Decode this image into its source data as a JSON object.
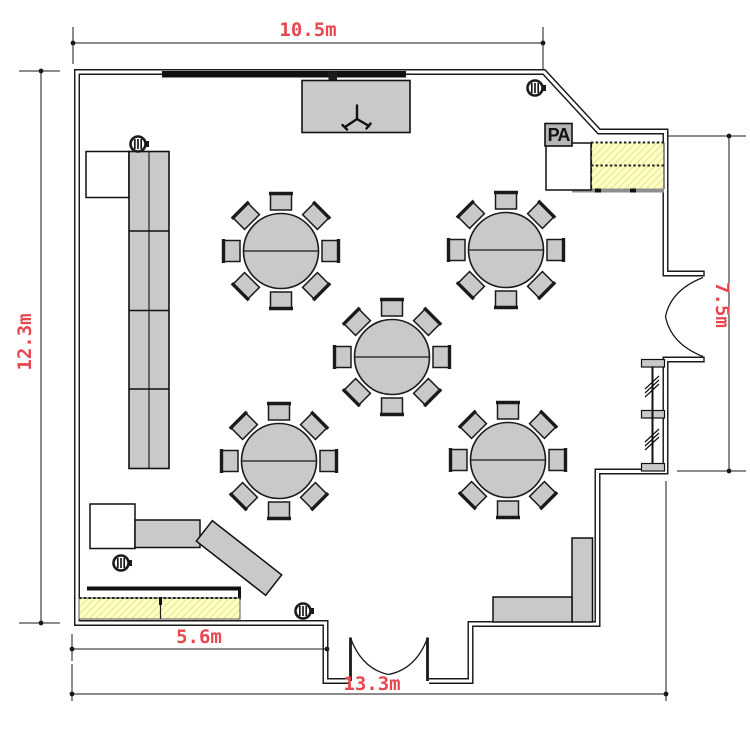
{
  "diagram": {
    "type": "floor-plan",
    "dims": {
      "top": "10.5m",
      "left": "12.3m",
      "right": "7.5m",
      "bottom_inner": "5.6m",
      "bottom_outer": "13.3m"
    },
    "labels": {
      "pa": "PA"
    },
    "colors": {
      "ink": "#1a1a1a",
      "dim_red": "#e8474f",
      "furniture_gray": "#c9c9c9",
      "hatch_fill": "#ffffca",
      "hatch_line": "#e2dc67"
    },
    "furniture": {
      "round_tables": {
        "count": 5,
        "seats_per_table": 8,
        "radius": 37.5,
        "centers": [
          [
            281,
            251
          ],
          [
            506,
            250
          ],
          [
            392,
            357
          ],
          [
            279,
            461
          ],
          [
            508,
            460
          ]
        ]
      },
      "fire_extinguishers": [
        [
          138,
          144
        ],
        [
          535,
          88
        ],
        [
          121,
          563
        ],
        [
          303,
          611
        ]
      ]
    }
  }
}
